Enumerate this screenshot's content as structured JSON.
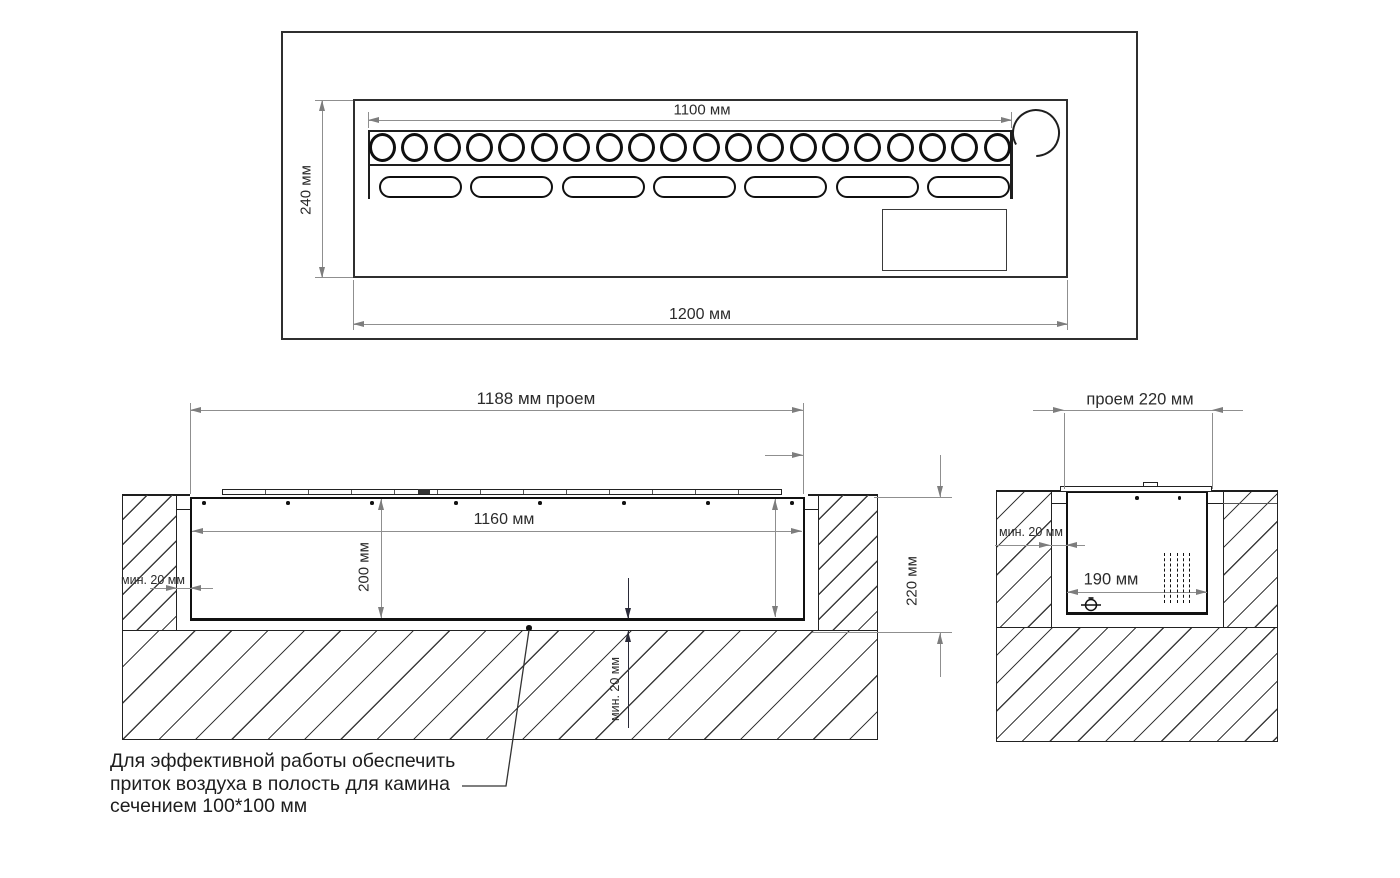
{
  "top_view": {
    "dim_burner_row": "1100 мм",
    "dim_height": "240 мм",
    "dim_width": "1200 мм",
    "burner_hole_count": 20,
    "slot_count": 7
  },
  "front_section": {
    "dim_opening": "1188 мм проем",
    "dim_inner_width": "1160 мм",
    "dim_inner_depth": "200 мм",
    "dim_side_gap_min": "мин. 20 мм",
    "dim_overall_depth": "220 мм",
    "dim_bottom_gap_min": "мин. 20 мм",
    "screw_dot_count": 8
  },
  "side_section": {
    "dim_opening": "проем 220 мм",
    "dim_side_gap_min": "мин. 20 мм",
    "dim_inner_width": "190 мм",
    "screw_dot_count": 2,
    "grill_bar_count": 5
  },
  "note": {
    "line1": "Для эффективной работы обеспечить",
    "line2": "приток воздуха в полость для камина",
    "line3": "сечением 100*100 мм"
  },
  "colors": {
    "object_line": "#1e1e1e",
    "dim_line": "#8f8f8f",
    "text": "#2b2b2b"
  }
}
